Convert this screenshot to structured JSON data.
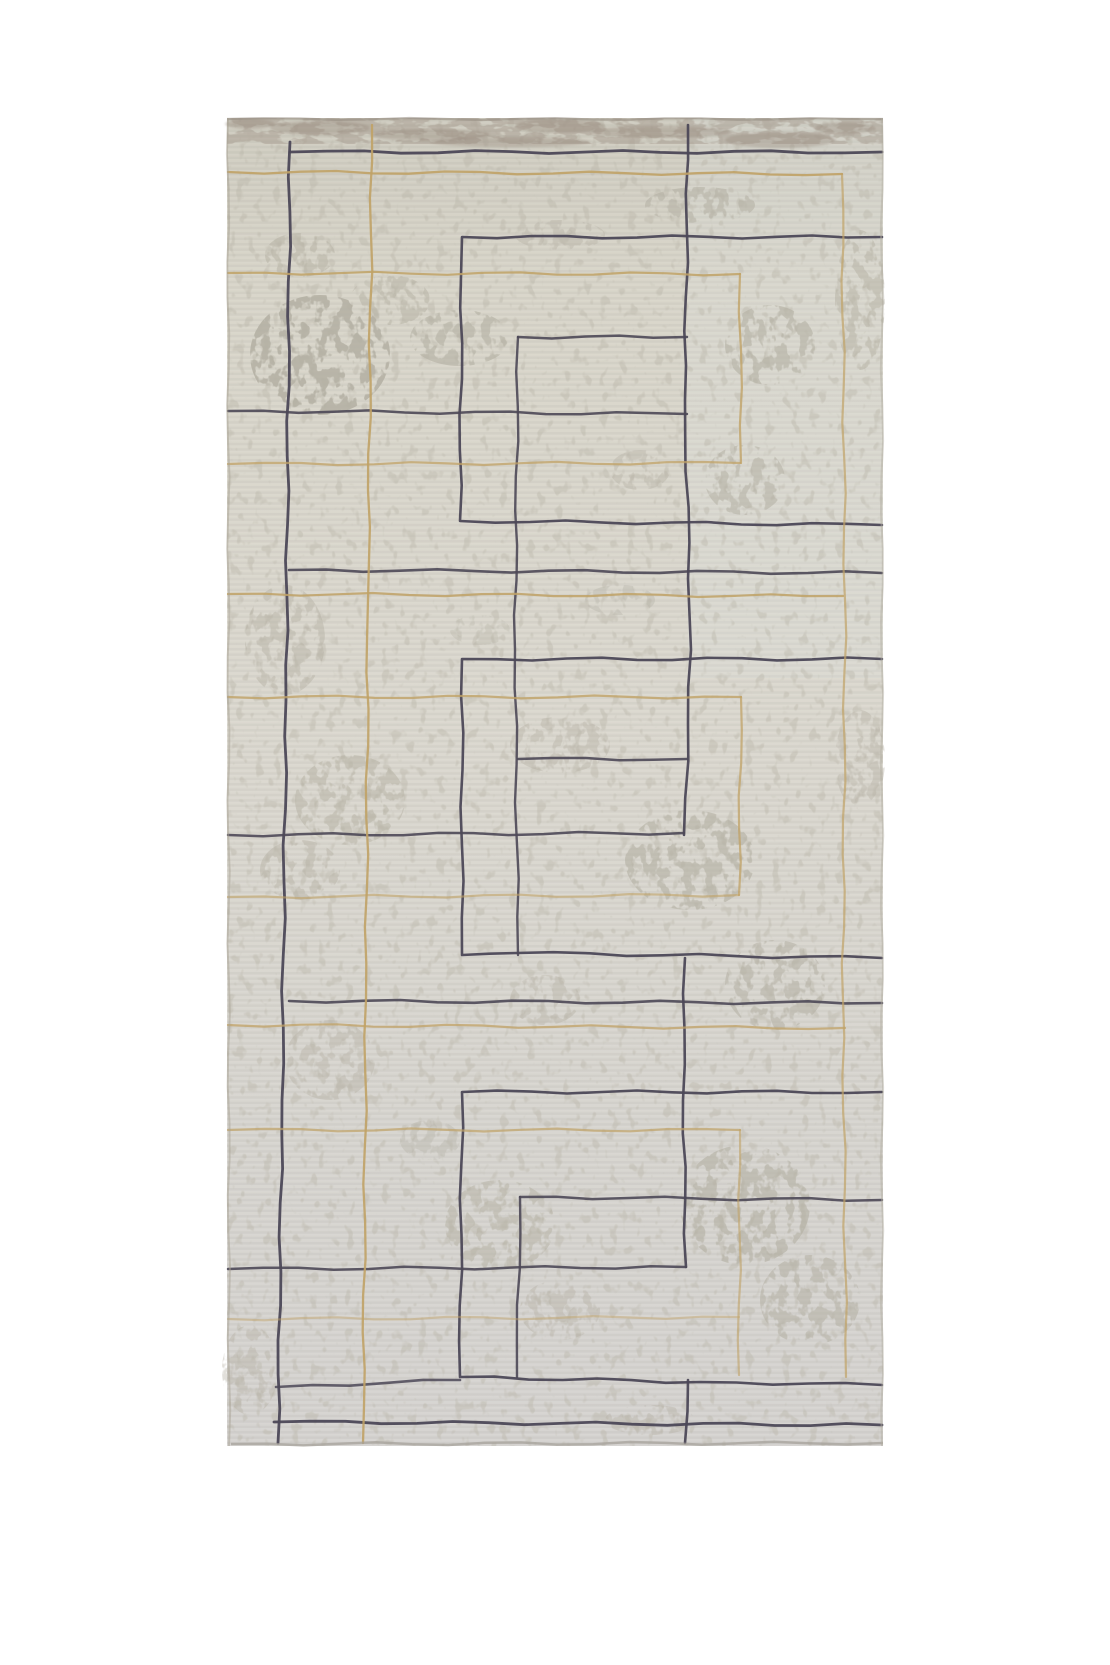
{
  "scene": {
    "type": "product-photo",
    "subject": "rectangular area rug with distressed ivory field and navy-gold geometric maze pattern",
    "background_color": "#ffffff"
  },
  "rug": {
    "x": 227,
    "y": 118,
    "width": 656,
    "height": 1328,
    "base_color": "#d8d5cb",
    "grad_top": "#cfccc0",
    "grad_mid": "#dcd9d0",
    "grad_bottom": "#d6d4d2",
    "blotch_color": "#b3afa2",
    "grain_color": "#b9b5a8",
    "band_color": "#a2968a",
    "band_streak_color": "#8f8276",
    "edge_color": "#938b7f",
    "navy": "#4c4857",
    "gold": "#c0a266",
    "pattern": {
      "lines": [
        {
          "pts": [
            [
              290,
              142
            ],
            [
              286,
              700
            ],
            [
              282,
              1100
            ],
            [
              278,
              1443
            ]
          ],
          "c": "navy",
          "w": 2.8,
          "o": 0.95
        },
        {
          "pts": [
            [
              290,
              152
            ],
            [
              882,
              152
            ]
          ],
          "c": "navy",
          "w": 2.8,
          "o": 0.95
        },
        {
          "pts": [
            [
              289,
              570
            ],
            [
              882,
              573
            ]
          ],
          "c": "navy",
          "w": 2.6,
          "o": 0.9
        },
        {
          "pts": [
            [
              289,
              1001
            ],
            [
              882,
              1003
            ]
          ],
          "c": "navy",
          "w": 2.6,
          "o": 0.9
        },
        {
          "pts": [
            [
              274,
              1422
            ],
            [
              882,
              1425
            ]
          ],
          "c": "navy",
          "w": 2.8,
          "o": 0.95
        },
        {
          "pts": [
            [
              882,
              237
            ],
            [
              462,
              237
            ],
            [
              460,
              521
            ],
            [
              882,
              525
            ]
          ],
          "c": "navy",
          "w": 2.6,
          "o": 0.95
        },
        {
          "pts": [
            [
              882,
              659
            ],
            [
              462,
              659
            ],
            [
              462,
              955
            ],
            [
              517,
              953
            ],
            [
              882,
              958
            ]
          ],
          "c": "navy",
          "w": 2.6,
          "o": 0.95
        },
        {
          "pts": [
            [
              882,
              1092
            ],
            [
              462,
              1092
            ],
            [
              460,
              1377
            ],
            [
              700,
              1382
            ],
            [
              882,
              1385
            ]
          ],
          "c": "navy",
          "w": 2.6,
          "o": 0.95
        },
        {
          "pts": [
            [
              276,
              1387
            ],
            [
              460,
              1380
            ]
          ],
          "c": "navy",
          "w": 2.6,
          "o": 0.85
        },
        {
          "pts": [
            [
              518,
              337
            ],
            [
              687,
              337
            ]
          ],
          "c": "navy",
          "w": 2.5,
          "o": 0.9
        },
        {
          "pts": [
            [
              518,
              759
            ],
            [
              687,
              759
            ]
          ],
          "c": "navy",
          "w": 2.5,
          "o": 0.9
        },
        {
          "pts": [
            [
              520,
              1197
            ],
            [
              882,
              1200
            ]
          ],
          "c": "navy",
          "w": 2.5,
          "o": 0.9
        },
        {
          "pts": [
            [
              518,
              337
            ],
            [
              515,
              650
            ],
            [
              518,
              955
            ]
          ],
          "c": "navy",
          "w": 2.4,
          "o": 0.9
        },
        {
          "pts": [
            [
              520,
              1197
            ],
            [
              517,
              1377
            ]
          ],
          "c": "navy",
          "w": 2.4,
          "o": 0.9
        },
        {
          "pts": [
            [
              688,
              125
            ],
            [
              685,
              400
            ],
            [
              691,
              650
            ],
            [
              684,
              835
            ]
          ],
          "c": "navy",
          "w": 2.6,
          "o": 0.95
        },
        {
          "pts": [
            [
              685,
              958
            ],
            [
              683,
              1100
            ],
            [
              686,
              1267
            ]
          ],
          "c": "navy",
          "w": 2.6,
          "o": 0.95
        },
        {
          "pts": [
            [
              688,
              1380
            ],
            [
              685,
              1443
            ]
          ],
          "c": "navy",
          "w": 2.6,
          "o": 0.95
        },
        {
          "pts": [
            [
              228,
              411
            ],
            [
              687,
              414
            ]
          ],
          "c": "navy",
          "w": 2.5,
          "o": 0.9
        },
        {
          "pts": [
            [
              228,
              835
            ],
            [
              684,
              833
            ]
          ],
          "c": "navy",
          "w": 2.5,
          "o": 0.9
        },
        {
          "pts": [
            [
              228,
              1269
            ],
            [
              686,
              1267
            ]
          ],
          "c": "navy",
          "w": 2.5,
          "o": 0.9
        },
        {
          "pts": [
            [
              372,
              125
            ],
            [
              368,
              600
            ],
            [
              366,
              1000
            ],
            [
              363,
              1443
            ]
          ],
          "c": "gold",
          "w": 2.3,
          "o": 0.9
        },
        {
          "pts": [
            [
              228,
              172
            ],
            [
              842,
              174
            ]
          ],
          "c": "gold",
          "w": 2.3,
          "o": 0.9
        },
        {
          "pts": [
            [
              842,
              174
            ],
            [
              845,
              600
            ],
            [
              843,
              1000
            ],
            [
              846,
              1377
            ]
          ],
          "c": "gold",
          "w": 2.2,
          "o": 0.7
        },
        {
          "pts": [
            [
              228,
              273
            ],
            [
              740,
              274
            ]
          ],
          "c": "gold",
          "w": 2.2,
          "o": 0.85
        },
        {
          "pts": [
            [
              740,
              274
            ],
            [
              741,
              463
            ]
          ],
          "c": "gold",
          "w": 2.2,
          "o": 0.8
        },
        {
          "pts": [
            [
              228,
              464
            ],
            [
              740,
              463
            ]
          ],
          "c": "gold",
          "w": 2.2,
          "o": 0.75
        },
        {
          "pts": [
            [
              228,
              594
            ],
            [
              843,
              596
            ]
          ],
          "c": "gold",
          "w": 2.2,
          "o": 0.85
        },
        {
          "pts": [
            [
              228,
              697
            ],
            [
              741,
              697
            ]
          ],
          "c": "gold",
          "w": 2.2,
          "o": 0.8
        },
        {
          "pts": [
            [
              741,
              697
            ],
            [
              739,
              895
            ]
          ],
          "c": "gold",
          "w": 2.2,
          "o": 0.75
        },
        {
          "pts": [
            [
              228,
              897
            ],
            [
              739,
              895
            ]
          ],
          "c": "gold",
          "w": 2.2,
          "o": 0.6
        },
        {
          "pts": [
            [
              228,
              1025
            ],
            [
              845,
              1028
            ]
          ],
          "c": "gold",
          "w": 2.2,
          "o": 0.75
        },
        {
          "pts": [
            [
              228,
              1130
            ],
            [
              740,
              1130
            ]
          ],
          "c": "gold",
          "w": 2.2,
          "o": 0.7
        },
        {
          "pts": [
            [
              740,
              1130
            ],
            [
              739,
              1375
            ]
          ],
          "c": "gold",
          "w": 2.2,
          "o": 0.6
        },
        {
          "pts": [
            [
              228,
              1319
            ],
            [
              739,
              1317
            ]
          ],
          "c": "gold",
          "w": 2.2,
          "o": 0.45
        }
      ]
    },
    "texture": {
      "blotches": [
        [
          320,
          355,
          70,
          60,
          0.85
        ],
        [
          390,
          300,
          40,
          25,
          0.5
        ],
        [
          460,
          338,
          50,
          28,
          0.6
        ],
        [
          300,
          255,
          35,
          22,
          0.5
        ],
        [
          560,
          235,
          45,
          15,
          0.4
        ],
        [
          700,
          205,
          55,
          18,
          0.55
        ],
        [
          770,
          345,
          45,
          40,
          0.6
        ],
        [
          745,
          480,
          40,
          35,
          0.55
        ],
        [
          860,
          300,
          25,
          70,
          0.5
        ],
        [
          640,
          470,
          30,
          20,
          0.4
        ],
        [
          285,
          640,
          40,
          55,
          0.45
        ],
        [
          350,
          800,
          55,
          45,
          0.5
        ],
        [
          300,
          870,
          40,
          30,
          0.45
        ],
        [
          560,
          745,
          50,
          28,
          0.4
        ],
        [
          690,
          860,
          65,
          50,
          0.6
        ],
        [
          775,
          985,
          50,
          45,
          0.55
        ],
        [
          545,
          1000,
          35,
          25,
          0.4
        ],
        [
          330,
          1060,
          45,
          40,
          0.4
        ],
        [
          745,
          1205,
          65,
          60,
          0.6
        ],
        [
          810,
          1300,
          50,
          45,
          0.55
        ],
        [
          500,
          1225,
          55,
          45,
          0.5
        ],
        [
          560,
          1310,
          40,
          30,
          0.4
        ],
        [
          250,
          1370,
          28,
          45,
          0.4
        ],
        [
          650,
          1420,
          45,
          15,
          0.4
        ],
        [
          430,
          1140,
          30,
          20,
          0.35
        ],
        [
          860,
          760,
          25,
          50,
          0.4
        ],
        [
          620,
          600,
          35,
          15,
          0.35
        ],
        [
          480,
          630,
          30,
          15,
          0.3
        ]
      ],
      "band_streaks": [
        [
          320,
          128,
          50,
          7
        ],
        [
          430,
          135,
          60,
          6
        ],
        [
          560,
          126,
          45,
          7
        ],
        [
          660,
          132,
          70,
          6
        ],
        [
          780,
          140,
          55,
          8
        ],
        [
          845,
          128,
          30,
          6
        ],
        [
          250,
          124,
          25,
          5
        ],
        [
          510,
          142,
          80,
          5
        ]
      ]
    }
  }
}
